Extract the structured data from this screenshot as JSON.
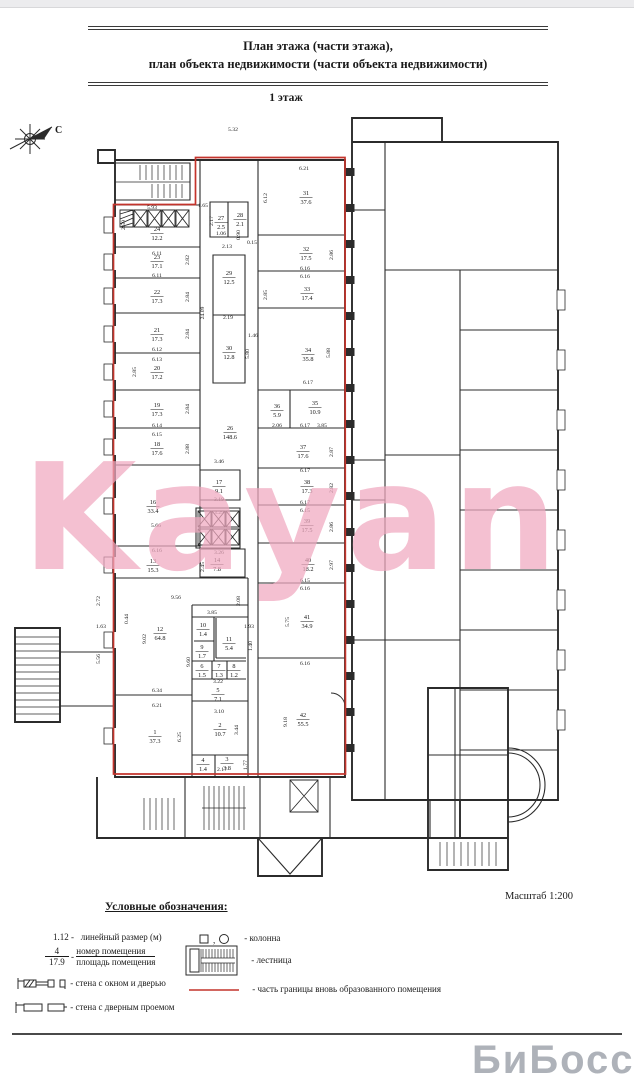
{
  "page": {
    "title_line1": "План этажа (части этажа),",
    "title_line2": "план объекта недвижимости (части объекта недвижимости)",
    "floor_label": "1 этаж",
    "scale_label": "Масштаб 1:200",
    "compass_label": "С",
    "watermark": "Kayan",
    "corner_watermark": "БиБосс"
  },
  "colors": {
    "boundary_red": "#c4342c",
    "walls": "#2b2b2b",
    "watermark_pink": "#f0a9c0"
  },
  "legend": {
    "title": "Условные обозначения:",
    "linear_dim_symbol": "1.12 -",
    "linear_dim_label": "линейный размер (м)",
    "room_number_example": "4",
    "room_area_example": "17.9",
    "dash": "-",
    "room_number_label": "номер помещения",
    "room_area_label": "площадь помещения",
    "wall_window_label": "- стена с окном и дверью",
    "wall_door_label": "- стена с дверным проемом",
    "column_symbols": "□ , ○",
    "column_label": "- колонна",
    "stairs_label": "- лестница",
    "red_line_label": "- часть границы вновь образованного помещения"
  },
  "plan": {
    "rooms": [
      {
        "n": "24",
        "a": "12.2",
        "x": 157,
        "y": 233
      },
      {
        "n": "23",
        "a": "17.1",
        "x": 157,
        "y": 261
      },
      {
        "n": "22",
        "a": "17.3",
        "x": 157,
        "y": 296
      },
      {
        "n": "21",
        "a": "17.3",
        "x": 157,
        "y": 334
      },
      {
        "n": "20",
        "a": "17.2",
        "x": 157,
        "y": 372
      },
      {
        "n": "19",
        "a": "17.3",
        "x": 157,
        "y": 409
      },
      {
        "n": "18",
        "a": "17.6",
        "x": 157,
        "y": 448
      },
      {
        "n": "16",
        "a": "33.4",
        "x": 153,
        "y": 506
      },
      {
        "n": "13",
        "a": "15.3",
        "x": 153,
        "y": 565
      },
      {
        "n": "12",
        "a": "64.8",
        "x": 160,
        "y": 633
      },
      {
        "n": "1",
        "a": "37.3",
        "x": 155,
        "y": 736
      },
      {
        "n": "27",
        "a": "2.5",
        "x": 221,
        "y": 222
      },
      {
        "n": "28",
        "a": "2.1",
        "x": 240,
        "y": 219
      },
      {
        "n": "29",
        "a": "12.5",
        "x": 229,
        "y": 277
      },
      {
        "n": "30",
        "a": "12.8",
        "x": 229,
        "y": 352
      },
      {
        "n": "26",
        "a": "148.6",
        "x": 230,
        "y": 432
      },
      {
        "n": "17",
        "a": "9.1",
        "x": 219,
        "y": 486
      },
      {
        "n": "14",
        "a": "7.8",
        "x": 217,
        "y": 564
      },
      {
        "n": "10",
        "a": "1.4",
        "x": 203,
        "y": 629
      },
      {
        "n": "11",
        "a": "5.4",
        "x": 229,
        "y": 643
      },
      {
        "n": "9",
        "a": "1.7",
        "x": 202,
        "y": 651
      },
      {
        "n": "6",
        "a": "1.5",
        "x": 202,
        "y": 670
      },
      {
        "n": "7",
        "a": "1.3",
        "x": 219,
        "y": 670
      },
      {
        "n": "8",
        "a": "1.2",
        "x": 234,
        "y": 670
      },
      {
        "n": "5",
        "a": "7.1",
        "x": 218,
        "y": 694
      },
      {
        "n": "2",
        "a": "10.7",
        "x": 220,
        "y": 729
      },
      {
        "n": "4",
        "a": "1.4",
        "x": 203,
        "y": 764
      },
      {
        "n": "3",
        "a": "3.8",
        "x": 227,
        "y": 763
      },
      {
        "n": "31",
        "a": "37.6",
        "x": 306,
        "y": 197
      },
      {
        "n": "32",
        "a": "17.5",
        "x": 306,
        "y": 253
      },
      {
        "n": "33",
        "a": "17.4",
        "x": 307,
        "y": 293
      },
      {
        "n": "34",
        "a": "35.8",
        "x": 308,
        "y": 354
      },
      {
        "n": "36",
        "a": "5.9",
        "x": 277,
        "y": 410
      },
      {
        "n": "35",
        "a": "10.9",
        "x": 315,
        "y": 407
      },
      {
        "n": "37",
        "a": "17.6",
        "x": 303,
        "y": 451
      },
      {
        "n": "38",
        "a": "17.3",
        "x": 307,
        "y": 486
      },
      {
        "n": "39",
        "a": "17.5",
        "x": 307,
        "y": 525
      },
      {
        "n": "40",
        "a": "18.2",
        "x": 308,
        "y": 564
      },
      {
        "n": "41",
        "a": "34.9",
        "x": 307,
        "y": 621
      },
      {
        "n": "42",
        "a": "55.5",
        "x": 303,
        "y": 719
      }
    ],
    "dims": [
      {
        "t": "5.32",
        "x": 233,
        "y": 131
      },
      {
        "t": "6.21",
        "x": 304,
        "y": 170
      },
      {
        "t": "6.12",
        "x": 267,
        "y": 198,
        "r": 1
      },
      {
        "t": "5.93",
        "x": 152,
        "y": 209
      },
      {
        "t": "2.59",
        "x": 125,
        "y": 225,
        "r": 1
      },
      {
        "t": "1.65",
        "x": 203,
        "y": 207
      },
      {
        "t": "2.17",
        "x": 213,
        "y": 221,
        "r": 1
      },
      {
        "t": "1.06",
        "x": 221,
        "y": 235
      },
      {
        "t": "0.90",
        "x": 240,
        "y": 235,
        "r": 1
      },
      {
        "t": "2.13",
        "x": 227,
        "y": 248
      },
      {
        "t": "0.15",
        "x": 252,
        "y": 244
      },
      {
        "t": "6.11",
        "x": 157,
        "y": 255
      },
      {
        "t": "2.82",
        "x": 189,
        "y": 260,
        "r": 1
      },
      {
        "t": "6.11",
        "x": 157,
        "y": 277
      },
      {
        "t": "2.84",
        "x": 189,
        "y": 297,
        "r": 1
      },
      {
        "t": "2.84",
        "x": 189,
        "y": 334,
        "r": 1
      },
      {
        "t": "6.12",
        "x": 157,
        "y": 351
      },
      {
        "t": "6.13",
        "x": 157,
        "y": 361
      },
      {
        "t": "2.85",
        "x": 136,
        "y": 372,
        "r": 1
      },
      {
        "t": "2.84",
        "x": 189,
        "y": 409,
        "r": 1
      },
      {
        "t": "6.14",
        "x": 157,
        "y": 427
      },
      {
        "t": "6.15",
        "x": 157,
        "y": 436
      },
      {
        "t": "2.88",
        "x": 189,
        "y": 449,
        "r": 1
      },
      {
        "t": "3.46",
        "x": 219,
        "y": 463
      },
      {
        "t": "5.66",
        "x": 156,
        "y": 527
      },
      {
        "t": "3.19",
        "x": 219,
        "y": 501
      },
      {
        "t": "3.29",
        "x": 219,
        "y": 514
      },
      {
        "t": "6.16",
        "x": 157,
        "y": 552
      },
      {
        "t": "3.26",
        "x": 219,
        "y": 554
      },
      {
        "t": "2.45",
        "x": 204,
        "y": 567,
        "r": 1
      },
      {
        "t": "9.56",
        "x": 176,
        "y": 599
      },
      {
        "t": "2.08",
        "x": 240,
        "y": 601,
        "r": 1
      },
      {
        "t": "2.72",
        "x": 100,
        "y": 601,
        "r": 1
      },
      {
        "t": "0.44",
        "x": 128,
        "y": 619,
        "r": 1
      },
      {
        "t": "1.63",
        "x": 101,
        "y": 628
      },
      {
        "t": "3.85",
        "x": 212,
        "y": 614
      },
      {
        "t": "1.93",
        "x": 249,
        "y": 628
      },
      {
        "t": "9.02",
        "x": 146,
        "y": 639,
        "r": 1
      },
      {
        "t": "5.56",
        "x": 100,
        "y": 659,
        "r": 1
      },
      {
        "t": "9.60",
        "x": 190,
        "y": 662,
        "r": 1
      },
      {
        "t": "1.40",
        "x": 252,
        "y": 646,
        "r": 1
      },
      {
        "t": "3.22",
        "x": 218,
        "y": 683
      },
      {
        "t": "6.34",
        "x": 157,
        "y": 692
      },
      {
        "t": "6.21",
        "x": 157,
        "y": 707
      },
      {
        "t": "6.25",
        "x": 181,
        "y": 737,
        "r": 1
      },
      {
        "t": "3.10",
        "x": 219,
        "y": 713
      },
      {
        "t": "3.44",
        "x": 238,
        "y": 730,
        "r": 1
      },
      {
        "t": "2.17",
        "x": 222,
        "y": 771
      },
      {
        "t": "1.77",
        "x": 247,
        "y": 765,
        "r": 1
      },
      {
        "t": "9.18",
        "x": 287,
        "y": 722,
        "r": 1
      },
      {
        "t": "6.16",
        "x": 305,
        "y": 665
      },
      {
        "t": "5.75",
        "x": 289,
        "y": 622,
        "r": 1
      },
      {
        "t": "6.15",
        "x": 305,
        "y": 582
      },
      {
        "t": "6.16",
        "x": 305,
        "y": 590
      },
      {
        "t": "2.97",
        "x": 333,
        "y": 565,
        "r": 1
      },
      {
        "t": "6.17",
        "x": 305,
        "y": 504
      },
      {
        "t": "6.15",
        "x": 305,
        "y": 512
      },
      {
        "t": "2.86",
        "x": 333,
        "y": 527,
        "r": 1
      },
      {
        "t": "2.82",
        "x": 333,
        "y": 488,
        "r": 1
      },
      {
        "t": "6.17",
        "x": 305,
        "y": 472
      },
      {
        "t": "2.87",
        "x": 333,
        "y": 452,
        "r": 1
      },
      {
        "t": "6.17",
        "x": 305,
        "y": 427
      },
      {
        "t": "2.06",
        "x": 277,
        "y": 427
      },
      {
        "t": "3.85",
        "x": 322,
        "y": 427
      },
      {
        "t": "6.17",
        "x": 308,
        "y": 384
      },
      {
        "t": "5.88",
        "x": 330,
        "y": 353,
        "r": 1
      },
      {
        "t": "1.46",
        "x": 253,
        "y": 337
      },
      {
        "t": "2.19",
        "x": 228,
        "y": 319
      },
      {
        "t": "24.09",
        "x": 204,
        "y": 313,
        "r": 1
      },
      {
        "t": "5.80",
        "x": 249,
        "y": 354,
        "r": 1
      },
      {
        "t": "2.86",
        "x": 333,
        "y": 255,
        "r": 1
      },
      {
        "t": "6.16",
        "x": 305,
        "y": 270
      },
      {
        "t": "6.16",
        "x": 305,
        "y": 278
      },
      {
        "t": "2.85",
        "x": 267,
        "y": 295,
        "r": 1
      }
    ]
  }
}
